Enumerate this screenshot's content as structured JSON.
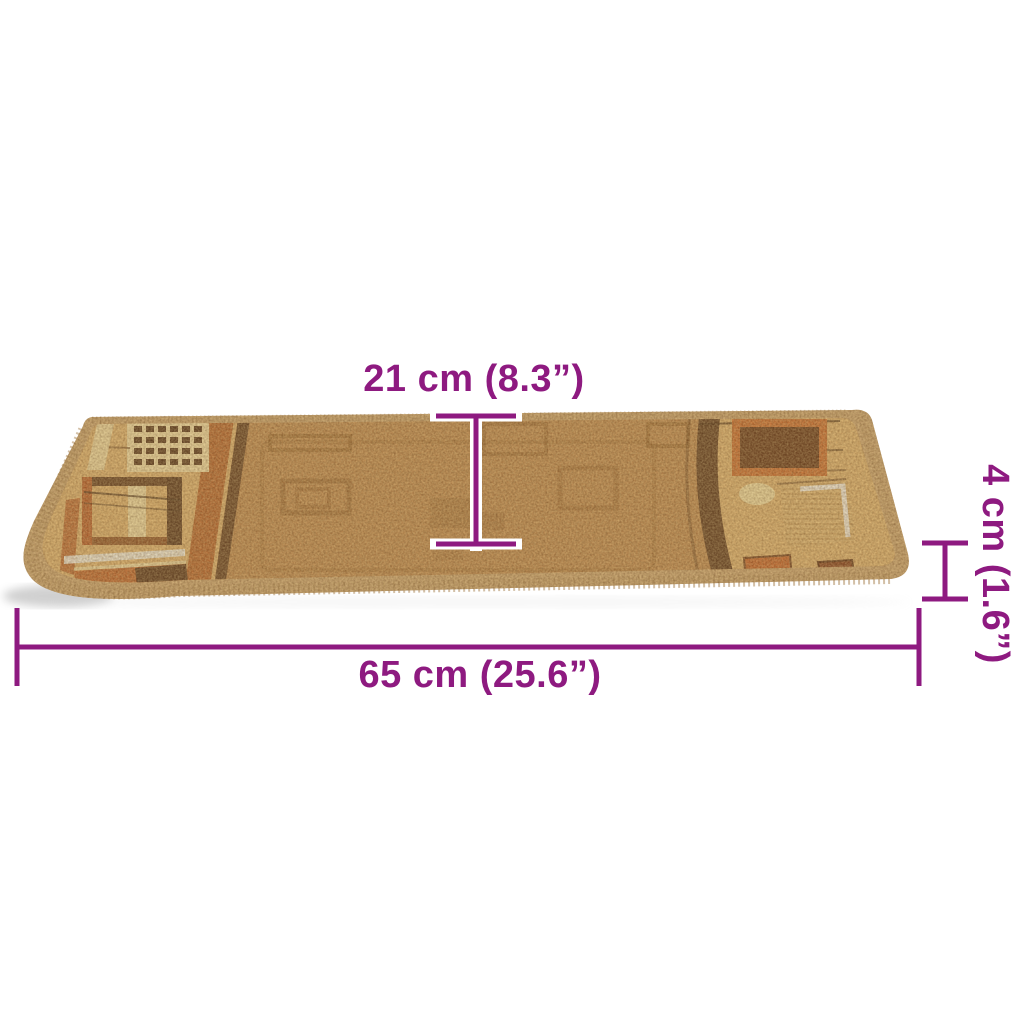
{
  "image": {
    "type": "product-dimension-illustration",
    "subject": "carpet stair tread mat in perspective view, beige-brown with geometric pattern ends",
    "background": "#ffffff"
  },
  "colors": {
    "dimension_color": "#8e1a80",
    "mat_field": "#b9854e",
    "mat_end_background": "#d8ad6d",
    "mat_binding": "#c6a06f",
    "accent_rust": "#b85c2b",
    "accent_dark_brown": "#5b381e",
    "accent_cream": "#ead7a2",
    "accent_silver": "#eceae4"
  },
  "dimensions": {
    "depth": {
      "label": "21 cm (8.3”)",
      "value_cm": 21,
      "value_inch": 8.3
    },
    "thickness": {
      "label": "4 cm (1.6”)",
      "value_cm": 4,
      "value_inch": 1.6
    },
    "width": {
      "label": "65 cm (25.6”)",
      "value_cm": 65,
      "value_inch": 25.6
    }
  }
}
